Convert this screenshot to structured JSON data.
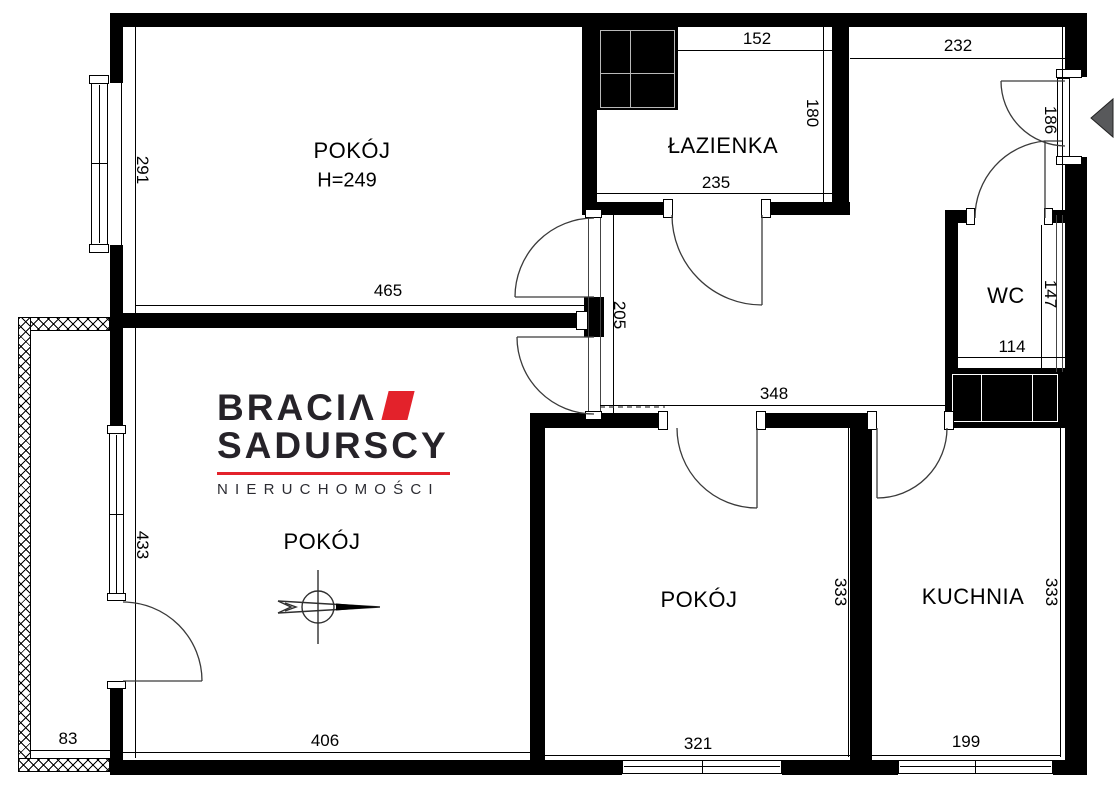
{
  "plan": {
    "rooms": {
      "room_top_left": {
        "label": "POKÓJ",
        "height_note": "H=249"
      },
      "bathroom": {
        "label": "ŁAZIENKA"
      },
      "wc": {
        "label": "WC"
      },
      "room_bottom_left": {
        "label": "POKÓJ"
      },
      "room_bottom_middle": {
        "label": "POKÓJ"
      },
      "kitchen": {
        "label": "KUCHNIA"
      }
    },
    "dims": {
      "d291": "291",
      "d465": "465",
      "d433": "433",
      "d83": "83",
      "d406": "406",
      "d152": "152",
      "d180": "180",
      "d235": "235",
      "d205": "205",
      "d232": "232",
      "d186": "186",
      "d147": "147",
      "d114": "114",
      "d348": "348",
      "d321": "321",
      "d333_room": "333",
      "d333_kitchen": "333",
      "d199": "199"
    }
  },
  "logo": {
    "brand_line1": "BRACIΛ",
    "brand_line2": "SADURSCY",
    "tagline": "NIERUCHOMOŚCI",
    "accent_color": "#e3222b",
    "text_color": "#262329"
  },
  "colors": {
    "walls": "#000000",
    "background": "#ffffff",
    "entry_arrow_fill": "#58595b",
    "door_arc_stroke": "#3a3a3a"
  }
}
